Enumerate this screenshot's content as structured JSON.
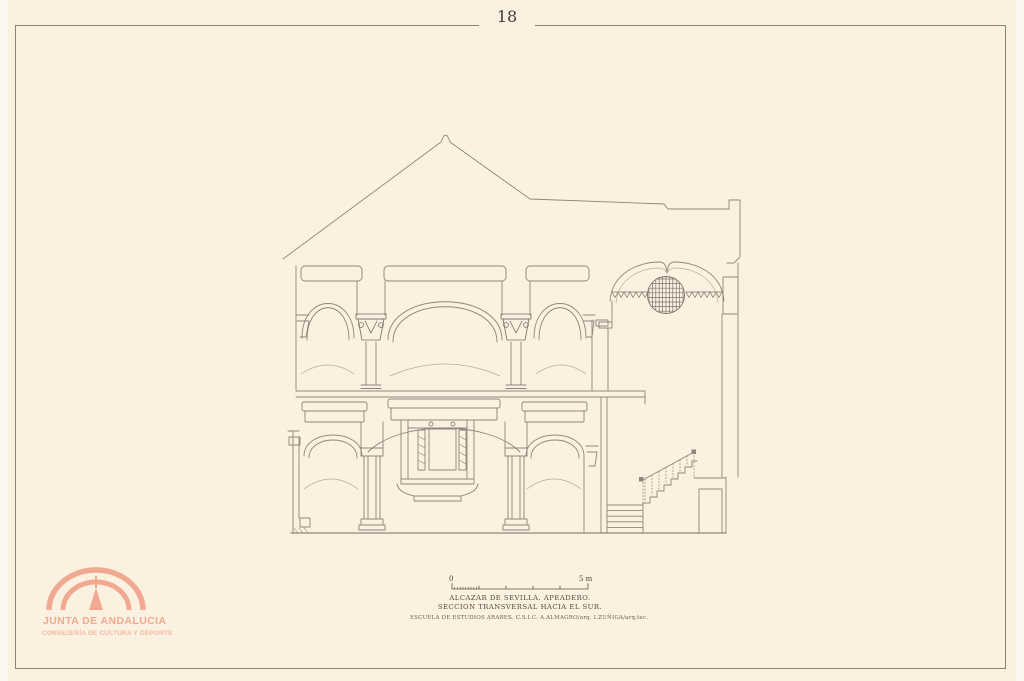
{
  "page": {
    "plate_number": "18"
  },
  "colors": {
    "paper": "#faf1e0",
    "frame_line": "#8b8374",
    "ink": "#8e8678",
    "text": "#4e463a",
    "logo_accent": "#f2a992",
    "logo_accent_light": "#f4b7a3"
  },
  "title_block": {
    "scale_bar": {
      "zero_label": "0",
      "end_label": "5 m"
    },
    "line1": "ALCAZAR DE SEVILLA. APEADERO.",
    "line2": "SECCION TRANSVERSAL HACIA EL SUR.",
    "credits": "ESCUELA DE ESTUDIOS ARABES. C.S.I.C.  A.ALMAGRO/arq.  I.ZUÑIGA/arq.tec."
  },
  "logo": {
    "organization": "JUNTA DE ANDALUCIA",
    "department": "CONSEJERÍA DE CULTURA Y DEPORTE"
  },
  "drawing": {
    "description": "Architectural cross-section: two-storey arcaded pavilion with gabled roof, lattice oculus tower and staircase"
  }
}
